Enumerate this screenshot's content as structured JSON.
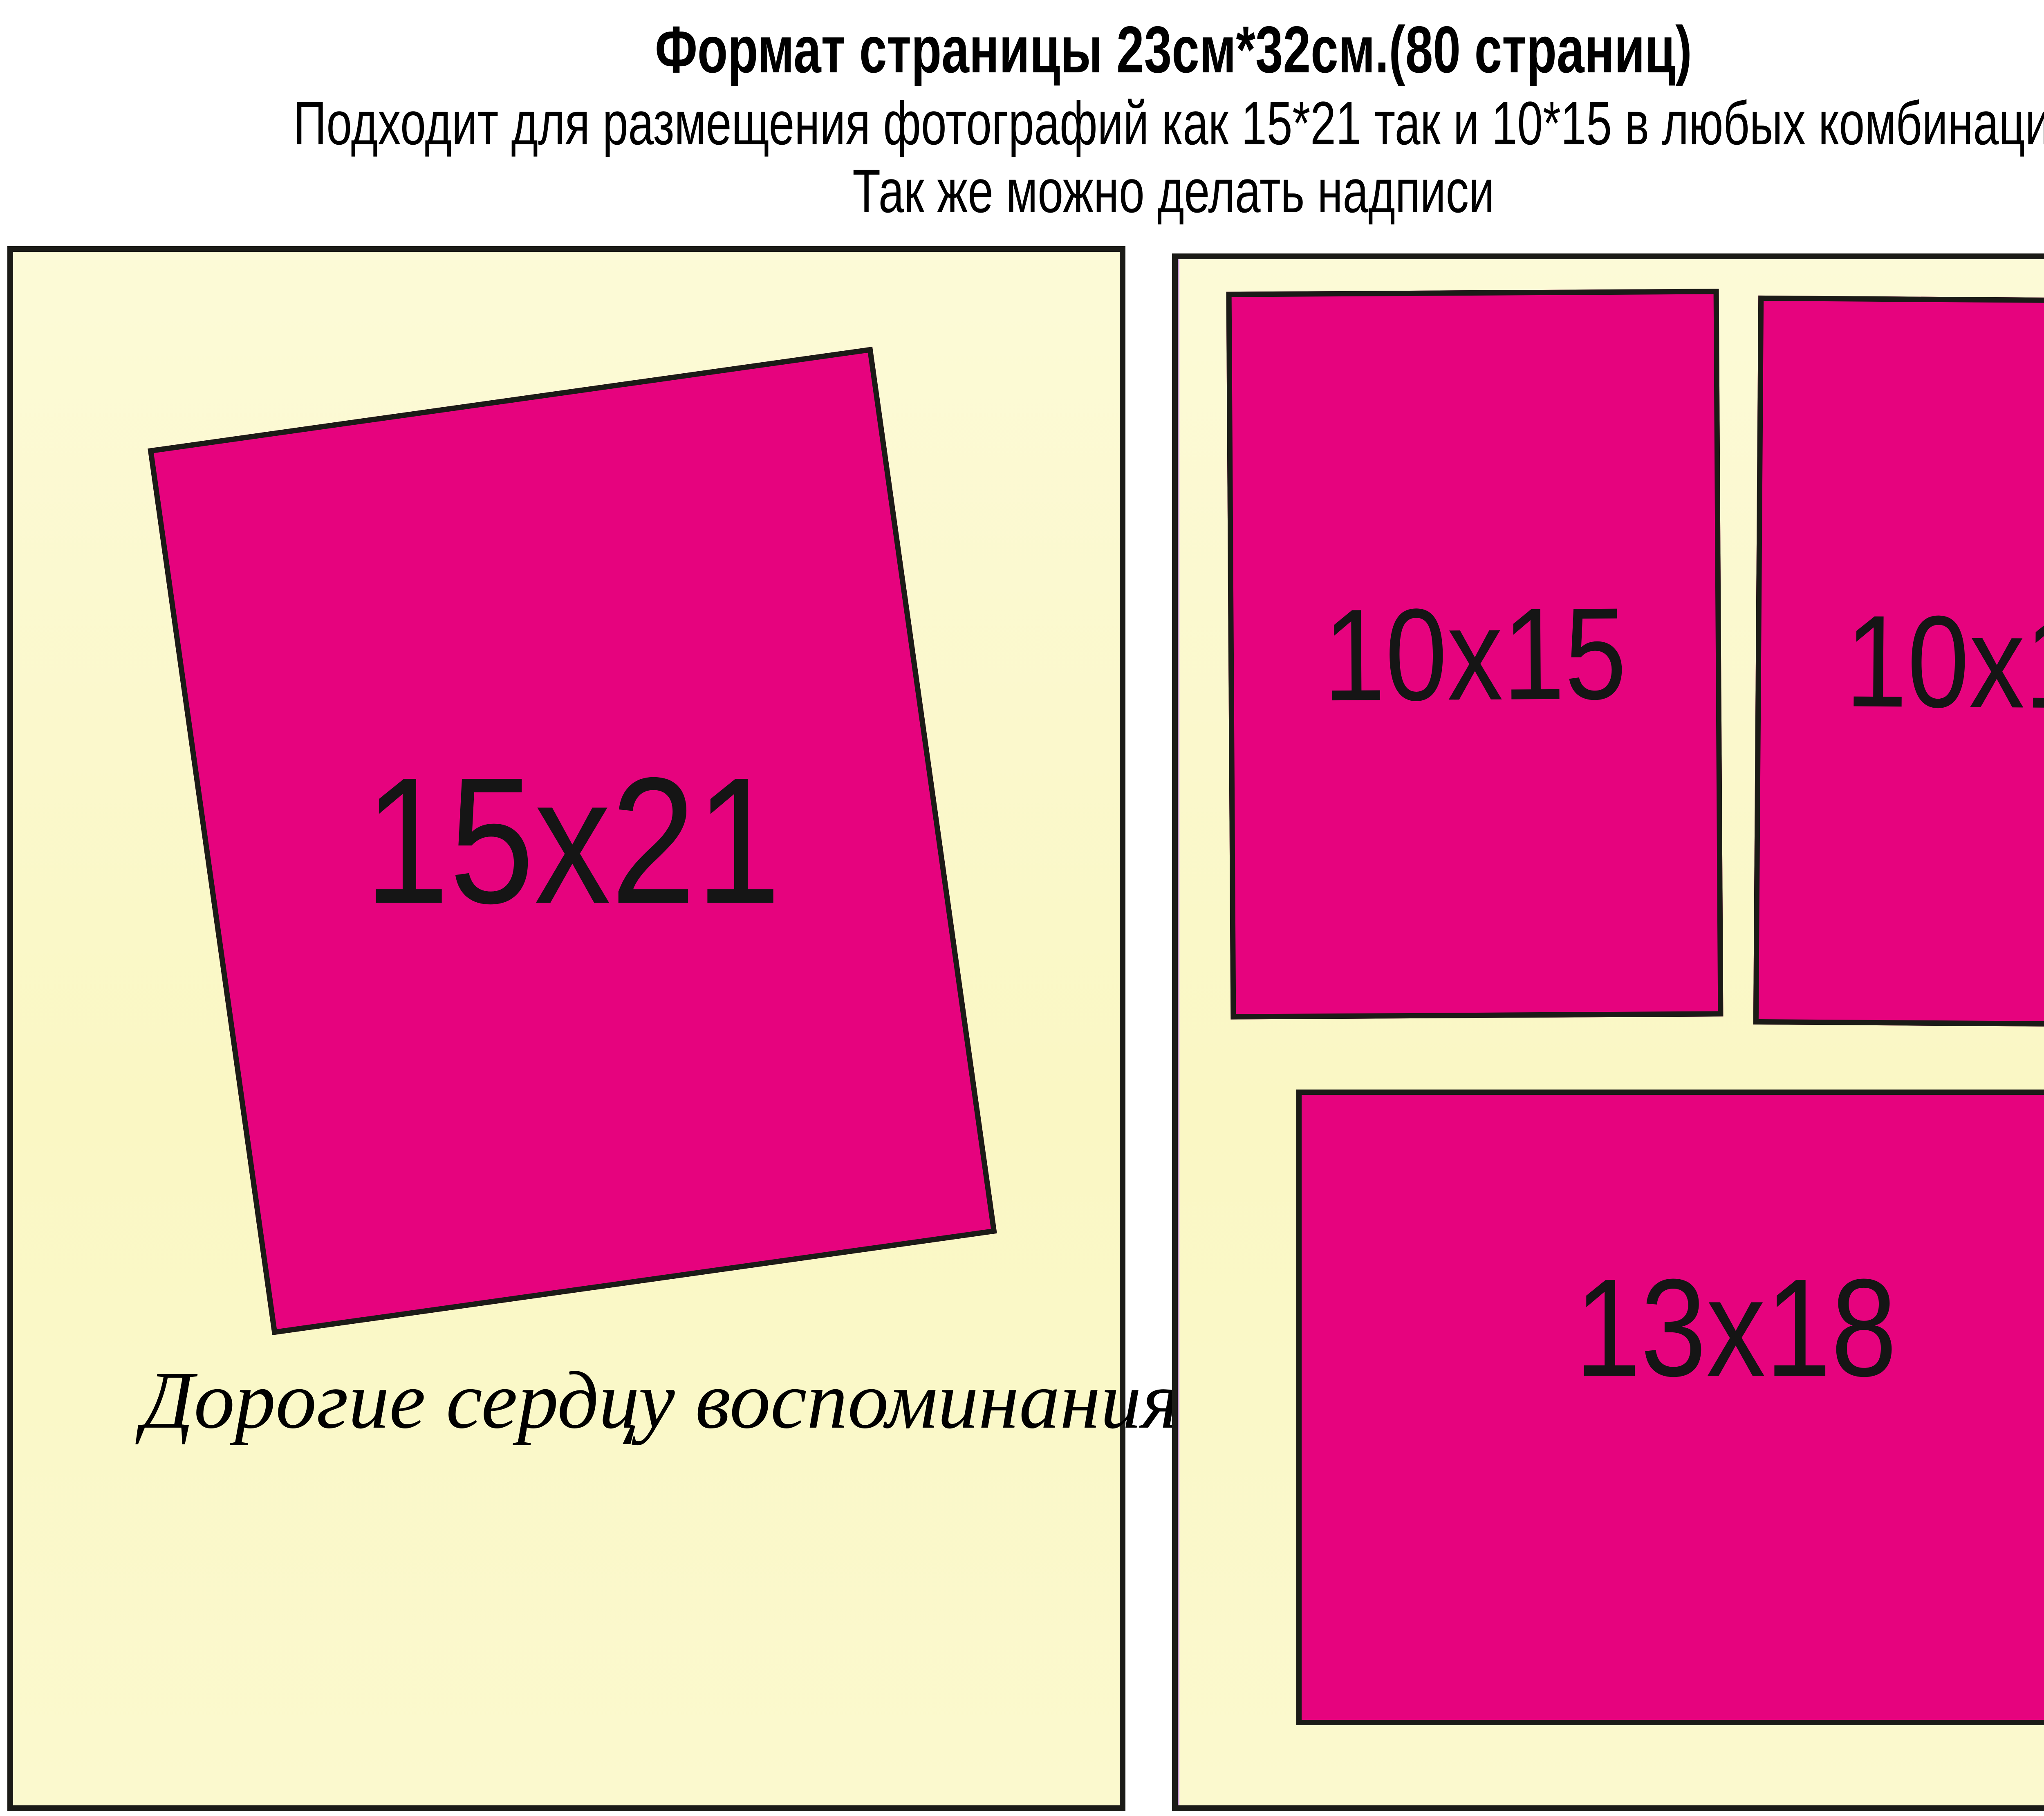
{
  "header": {
    "line1": "Формат страницы 23см*32см.(80 страниц)",
    "line2": "Подходит для размещения фотографий как 15*21 так и 10*15 в любых комбинация",
    "line3": "Так же можно делать надписи"
  },
  "left_page": {
    "photo_15x21_label": "15x21",
    "caption": "Дорогие сердцу воспоминания..."
  },
  "right_page": {
    "photo_10x15_left_label": "10x15",
    "photo_10x15_right_label": "10x15",
    "photo_13x18_label": "13x18"
  },
  "colors": {
    "photo_fill": "#E6037E",
    "page_fill": "#FBF8C9",
    "outline": "#1B1B17",
    "background": "#FFFFFF",
    "page_edge_artifact": "#C07BE4"
  }
}
